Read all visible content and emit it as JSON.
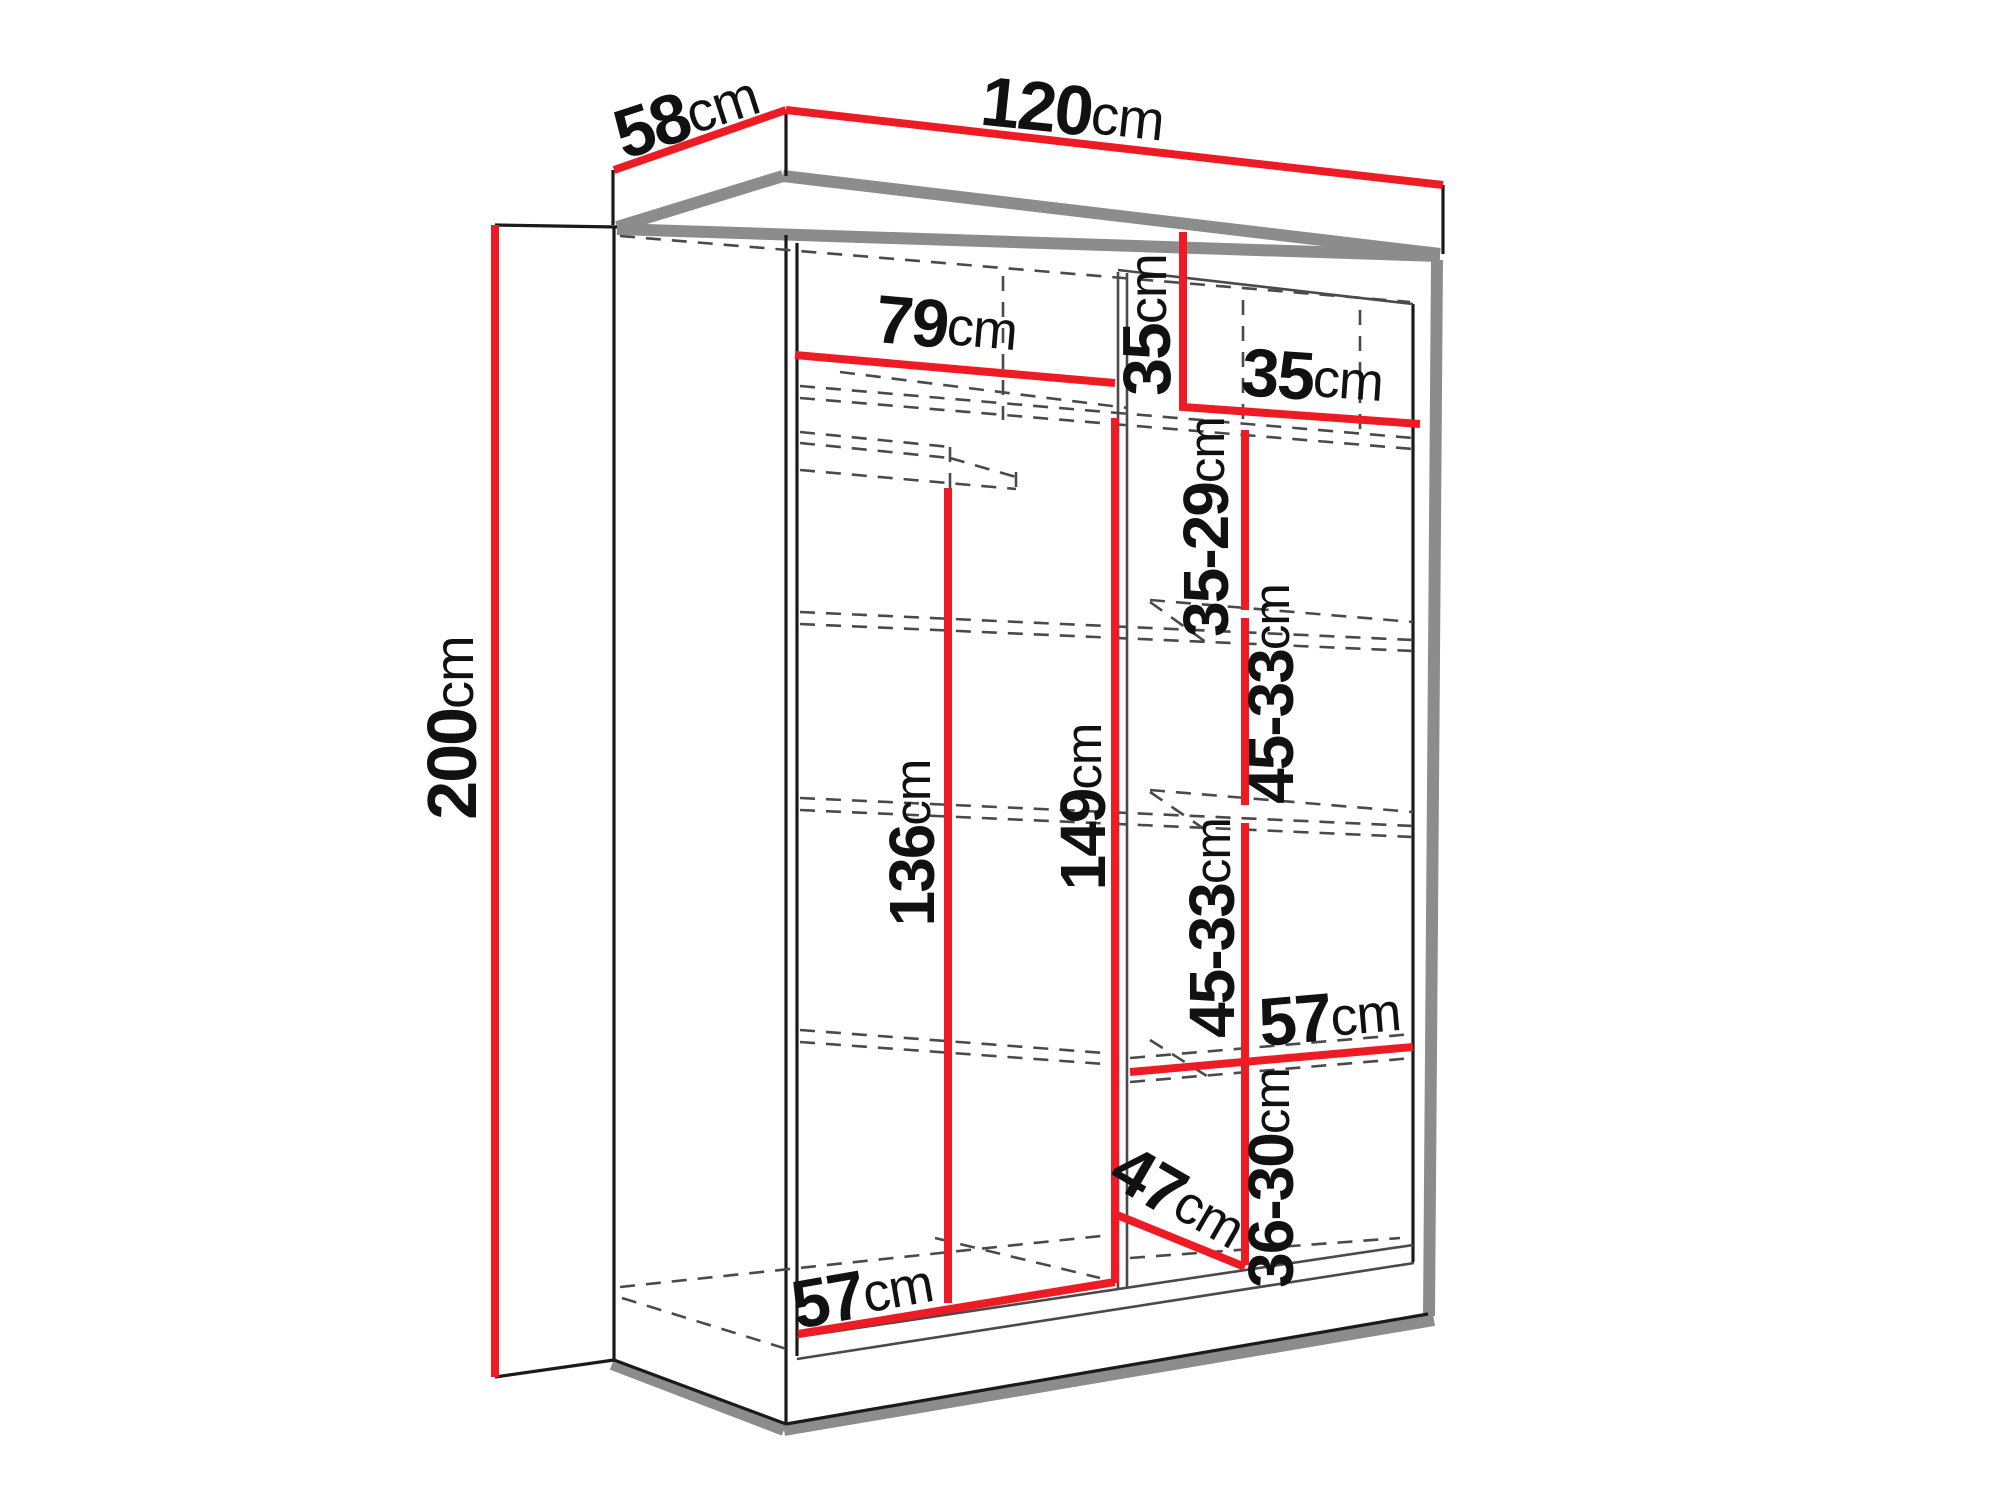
{
  "diagram": {
    "title": "wardrobe-interior-dimension-diagram",
    "unit": "cm",
    "colors": {
      "dimension_red": "#ED1C24",
      "outline_black": "#1a1a1a",
      "shadow_gray": "#8C8C8C",
      "interior_gray": "#4a4a4a",
      "background": "#ffffff"
    },
    "overall": {
      "width_cm": "120",
      "depth_cm": "58",
      "height_cm": "200"
    },
    "labels": {
      "height_total": {
        "value": "200",
        "unit": "cm"
      },
      "depth_top": {
        "value": "58",
        "unit": "cm"
      },
      "width_top": {
        "value": "120",
        "unit": "cm"
      },
      "left_section_width": {
        "value": "79",
        "unit": "cm"
      },
      "top_compartment_height": {
        "value": "35",
        "unit": "cm"
      },
      "top_shelf_width": {
        "value": "35",
        "unit": "cm"
      },
      "shelf_gap_1": {
        "value": "35-29",
        "unit": "cm"
      },
      "shelf_gap_2": {
        "value": "45-33",
        "unit": "cm"
      },
      "shelf_gap_3": {
        "value": "45-33",
        "unit": "cm"
      },
      "shelf_gap_4": {
        "value": "36-30",
        "unit": "cm"
      },
      "right_shelf_width": {
        "value": "57",
        "unit": "cm"
      },
      "hanging_space_height": {
        "value": "136",
        "unit": "cm"
      },
      "left_section_height": {
        "value": "149",
        "unit": "cm"
      },
      "bottom_diagonal_depth": {
        "value": "47",
        "unit": "cm"
      },
      "bottom_shelf_width": {
        "value": "57",
        "unit": "cm"
      }
    }
  }
}
